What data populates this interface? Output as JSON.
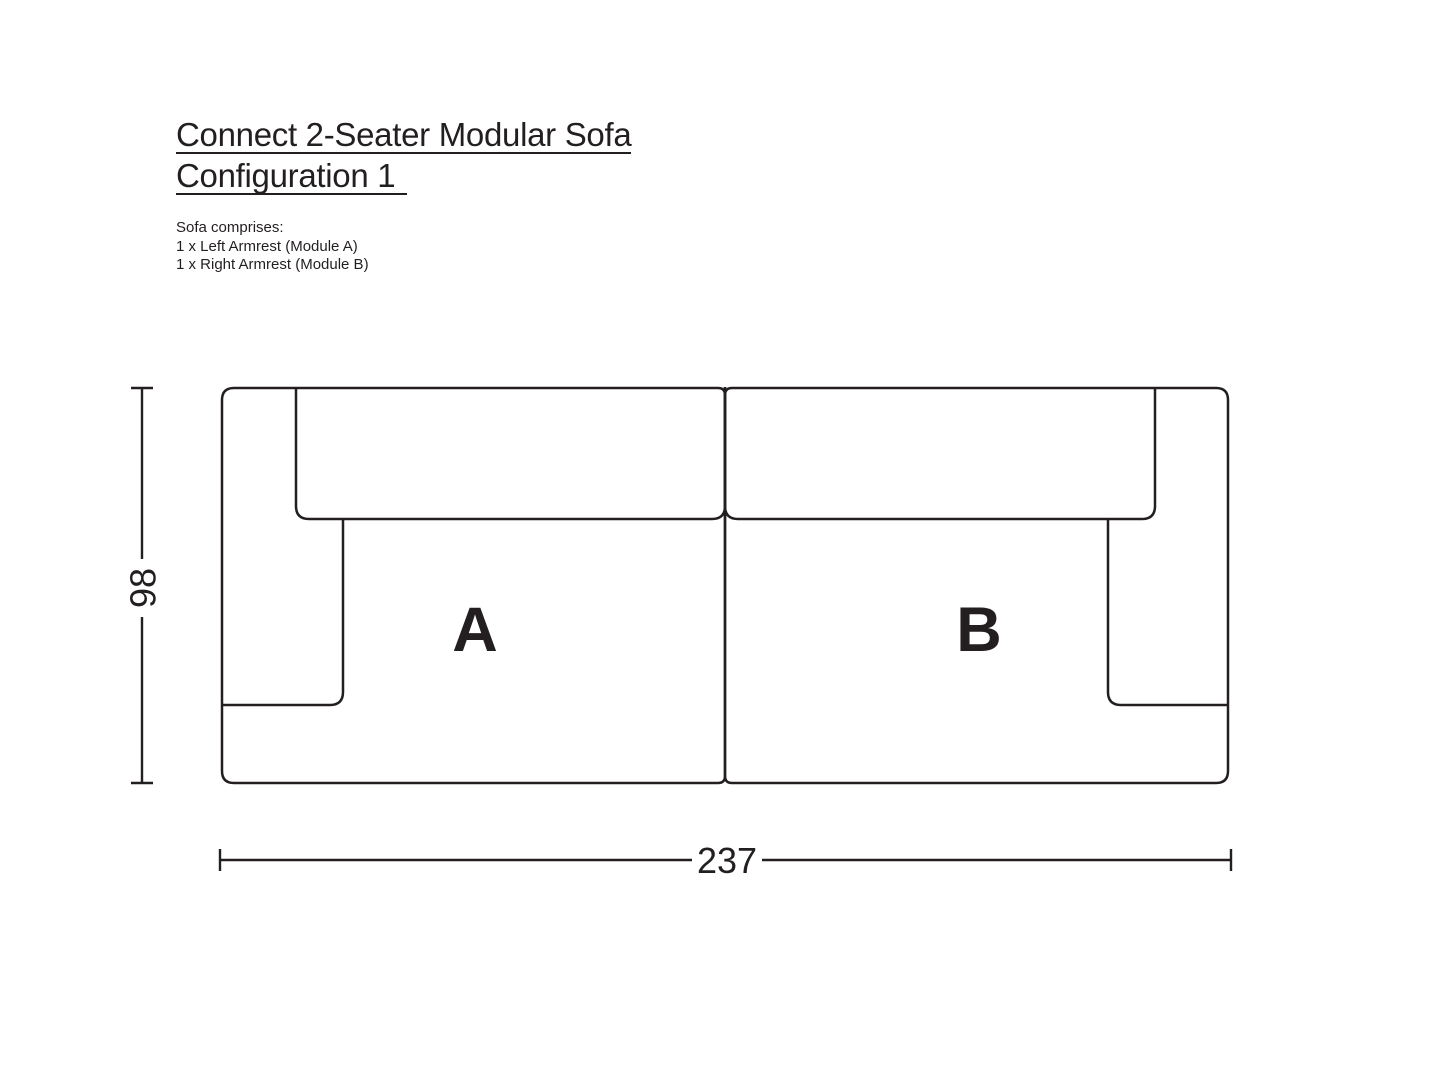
{
  "page": {
    "background_color": "#ffffff",
    "ink_color": "#231f20",
    "title_line1": "Connect 2-Seater Modular Sofa",
    "title_line2": "Configuration 1"
  },
  "description": {
    "heading": "Sofa comprises:",
    "items": [
      "1 x Left Armrest (Module A)",
      "1 x Right Armrest (Module B)"
    ]
  },
  "diagram": {
    "module_a_label": "A",
    "module_b_label": "B",
    "width_dimension": "237",
    "height_dimension": "98"
  }
}
